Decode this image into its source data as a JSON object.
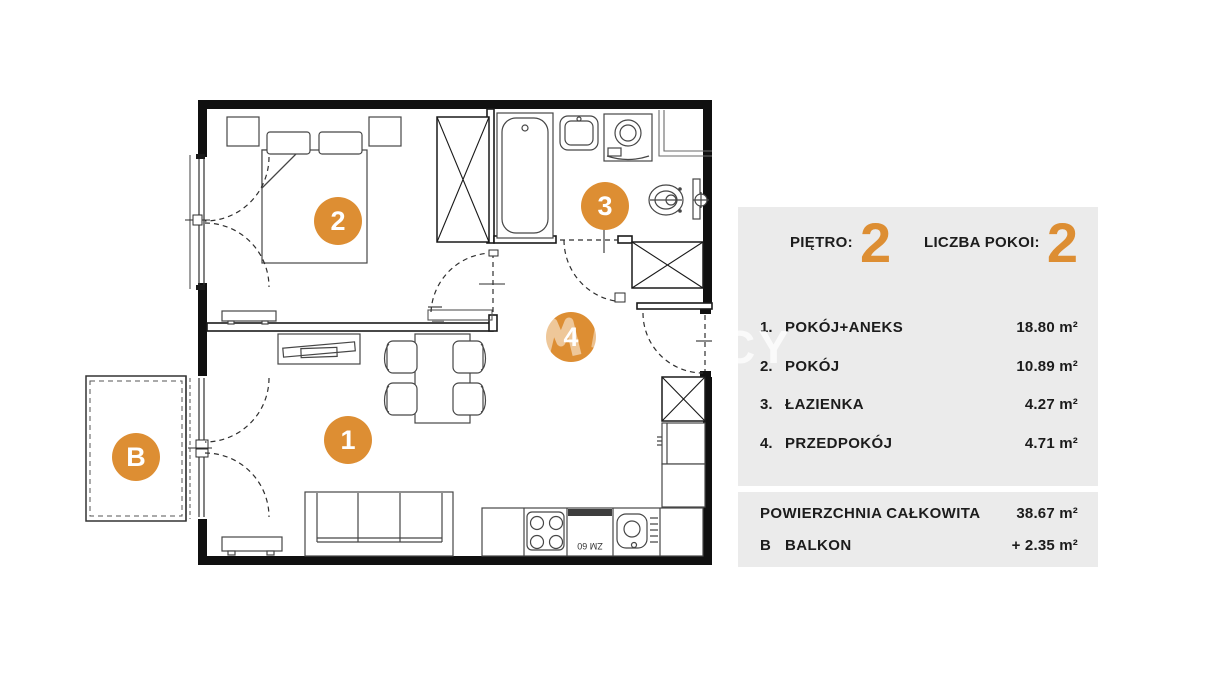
{
  "colors": {
    "accent": "#DD8E33",
    "panel": "#EBEBEB"
  },
  "watermark": {
    "text": "CY"
  },
  "plan": {
    "appliance_label": "ZM 60",
    "markers": [
      {
        "room": "pokoj-aneks",
        "label": "1"
      },
      {
        "room": "pokoj",
        "label": "2"
      },
      {
        "room": "lazienka",
        "label": "3"
      },
      {
        "room": "przedpokoj",
        "label": "4"
      },
      {
        "room": "balkon",
        "label": "B"
      }
    ]
  },
  "legend": {
    "floor": {
      "label": "PIĘTRO:",
      "value": "2"
    },
    "room_count": {
      "label": "LICZBA POKOI:",
      "value": "2"
    },
    "rooms": [
      {
        "num": "1.",
        "name": "POKÓJ+ANEKS",
        "area": "18.80 m²"
      },
      {
        "num": "2.",
        "name": "POKÓJ",
        "area": "10.89 m²"
      },
      {
        "num": "3.",
        "name": "ŁAZIENKA",
        "area": "4.27 m²"
      },
      {
        "num": "4.",
        "name": "PRZEDPOKÓJ",
        "area": "4.71 m²"
      }
    ],
    "total": {
      "label": "POWIERZCHNIA CAŁKOWITA",
      "area": "38.67 m²"
    },
    "balcony": {
      "num": "B",
      "label": "BALKON",
      "area": "+ 2.35 m²"
    }
  }
}
